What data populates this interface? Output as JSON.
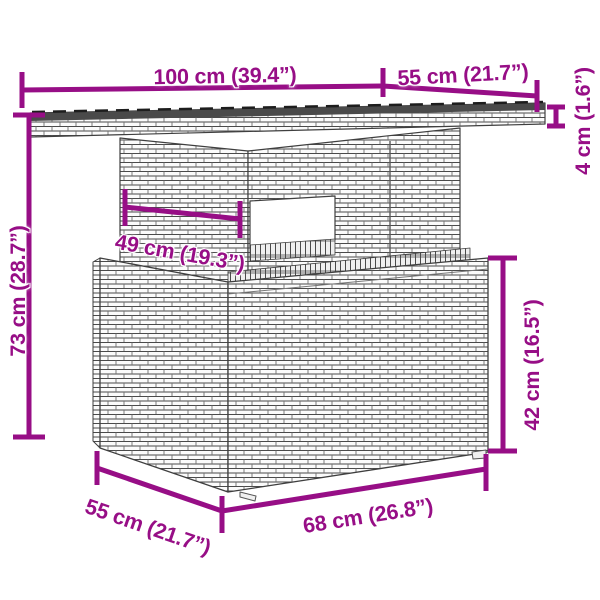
{
  "figure": {
    "type": "product-dimension-diagram",
    "subject": "rattan-wicker-garden-table"
  },
  "accent_color": "#970e86",
  "line_color": "#3f3f3f",
  "labels": {
    "top_width": "100 cm (39.4”)",
    "top_depth": "55 cm (21.7”)",
    "top_thickness": "4 cm (1.6”)",
    "total_height": "73 cm (28.7”)",
    "inner_width": "49 cm (19.3”)",
    "base_height": "42 cm (16.5”)",
    "base_depth": "55 cm (21.7”)",
    "base_width": "68 cm (26.8”)"
  }
}
